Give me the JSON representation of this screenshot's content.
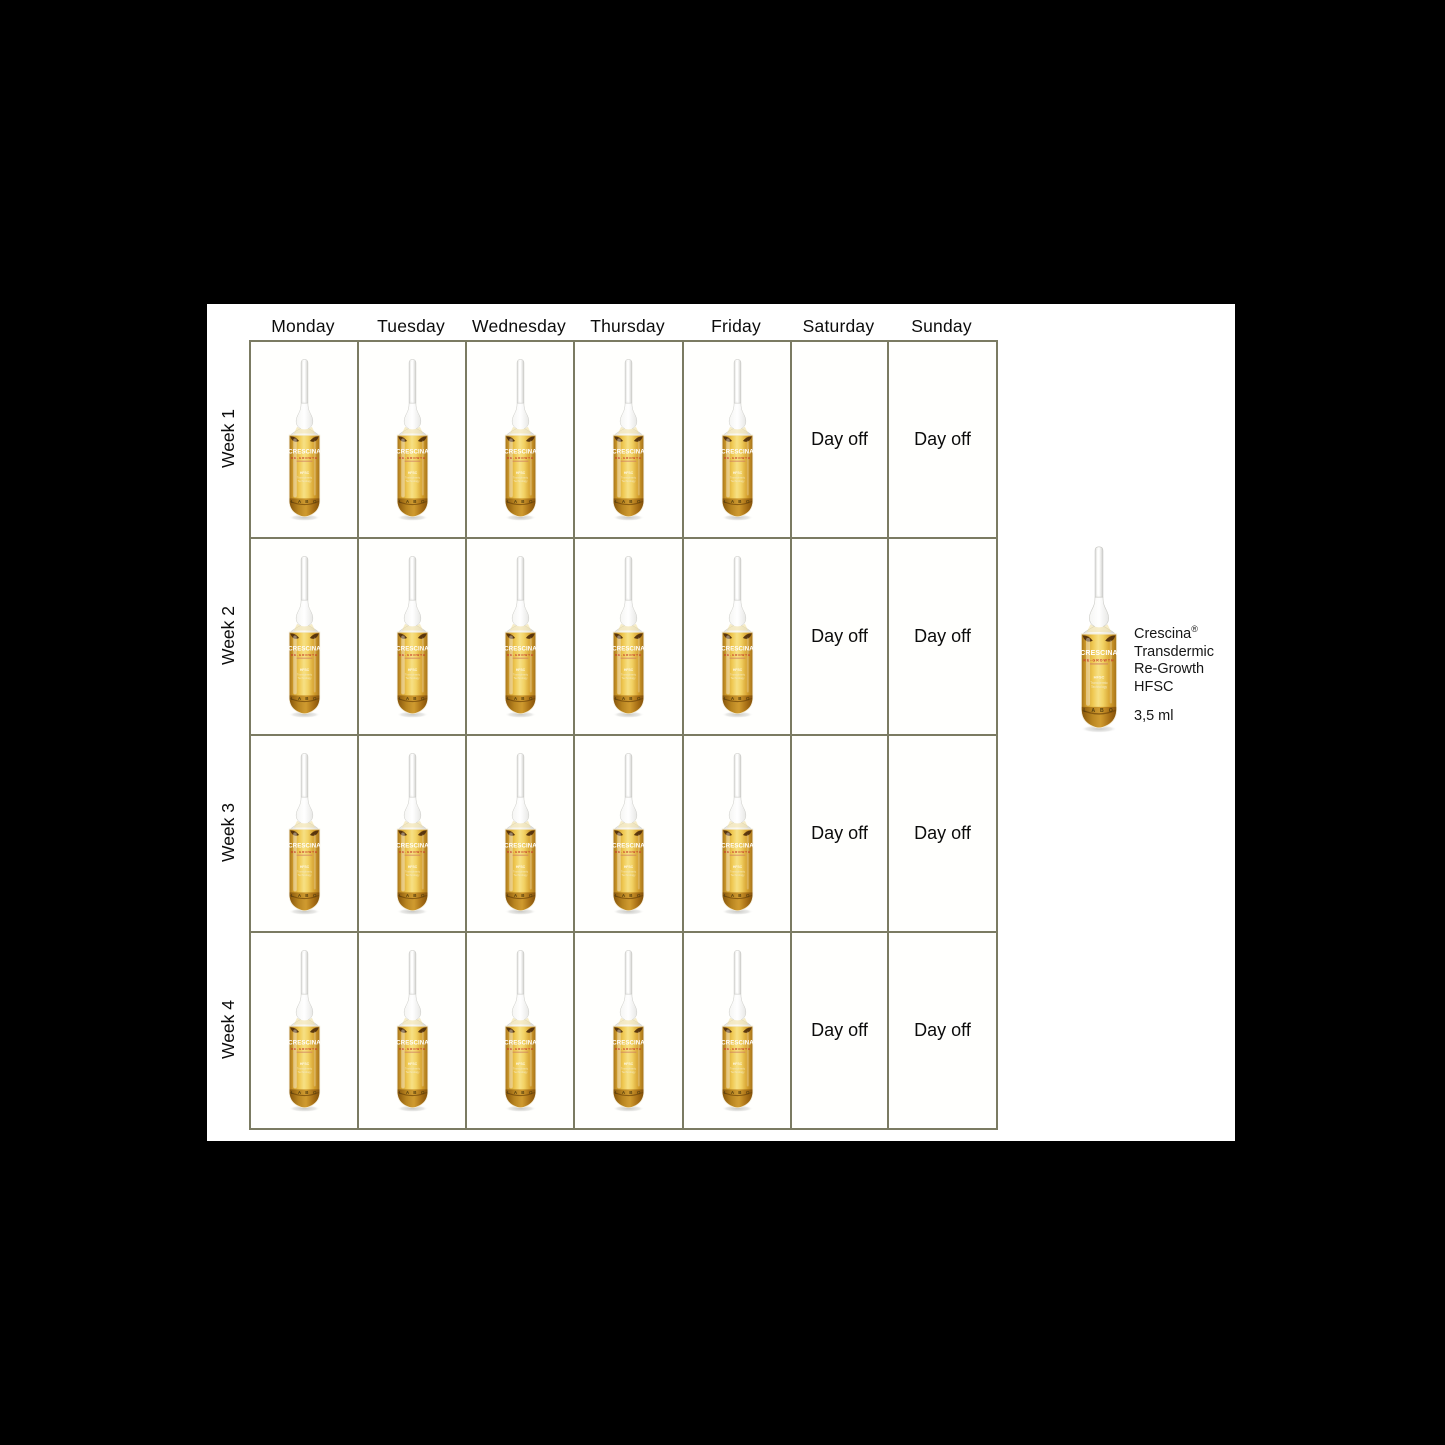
{
  "window": {
    "background_color": "#000000",
    "canvas_background_color": "#ffffff"
  },
  "schedule": {
    "day_headers": [
      "Monday",
      "Tuesday",
      "Wednesday",
      "Thursday",
      "Friday",
      "Saturday",
      "Sunday"
    ],
    "weeks": [
      {
        "label": "Week 1"
      },
      {
        "label": "Week 2"
      },
      {
        "label": "Week 3"
      },
      {
        "label": "Week 4"
      }
    ],
    "ampoule_days": [
      "Monday",
      "Tuesday",
      "Wednesday",
      "Thursday",
      "Friday"
    ],
    "day_off_days": [
      "Saturday",
      "Sunday"
    ],
    "day_off_label": "Day off",
    "grid_border_color": "#7b7b62"
  },
  "product": {
    "name": "Crescina",
    "trademark_symbol": "®",
    "description_lines": [
      "Transdermic",
      "Re-Growth",
      "HFSC"
    ],
    "volume": "3,5 ml",
    "ampoule_label": {
      "brand": "CRESCINA",
      "range": "RE-GROWTH",
      "hfsc": "HFSC",
      "tech_line_1": "Transdermic",
      "tech_line_2": "Technology",
      "maker": "L A B O"
    },
    "colors": {
      "liquid_center": "#f7e084",
      "liquid_mid": "#efc852",
      "liquid_edge": "#a9761a",
      "base_amber": "#8a5a0e",
      "meniscus_spot": "#4e2c0a",
      "range_text_red": "#c63b2b"
    }
  }
}
